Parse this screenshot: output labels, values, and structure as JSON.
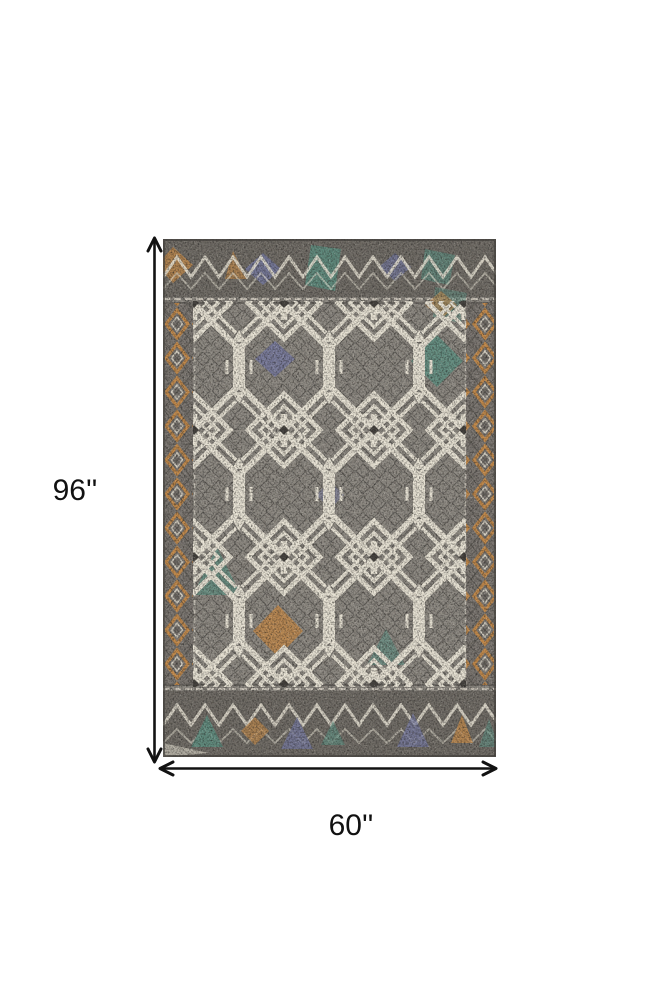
{
  "diagram": {
    "type": "product-dimensions",
    "height_label": "96''",
    "width_label": "60''"
  },
  "rug": {
    "description": "Gray ivory taupe and orange geometric tribal-pattern area rug with teal and slate accents",
    "icons": [
      "vertical-double-arrow-icon",
      "horizontal-double-arrow-icon"
    ]
  },
  "colors": {
    "background": "#ffffff",
    "arrow": "#121212",
    "label-text": "#111111",
    "rug-ground": "#8f8b84",
    "rug-band": "#716d67",
    "rug-ivory": "#e8e3d5",
    "rug-dark": "#46433f",
    "rug-teal": "#5d9183",
    "rug-orange": "#c28a4c",
    "rug-slate": "#7579a2",
    "rug-edge": "#44413d"
  }
}
